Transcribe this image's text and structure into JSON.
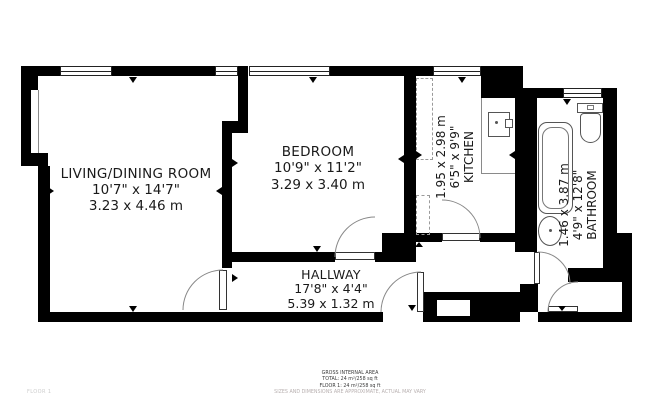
{
  "meta": {
    "floor_label": "FLOOR 1"
  },
  "rooms": [
    {
      "id": "living",
      "name": "LIVING/DINING ROOM",
      "imperial": "10'7\" x 14'7\"",
      "metric": "3.23 x 4.46 m"
    },
    {
      "id": "bedroom",
      "name": "BEDROOM",
      "imperial": "10'9\" x 11'2\"",
      "metric": "3.29 x 3.40 m"
    },
    {
      "id": "kitchen",
      "name": "KITCHEN",
      "imperial": "6'5\" x 9'9\"",
      "metric": "1.95 x 2.98 m"
    },
    {
      "id": "bathroom",
      "name": "BATHROOM",
      "imperial": "4'9\" x 12'8\"",
      "metric": "1.46 x 3.87 m"
    },
    {
      "id": "hallway",
      "name": "HALLWAY",
      "imperial": "17'8\" x 4'4\"",
      "metric": "5.39 x 1.32 m"
    }
  ],
  "footer": {
    "line1": "GROSS INTERNAL AREA",
    "line2": "TOTAL: 24 m²/258 sq ft",
    "line3": "FLOOR 1: 24 m²/258 sq ft",
    "disclaimer": "SIZES AND DIMENSIONS ARE APPROXIMATE, ACTUAL MAY VARY"
  },
  "fixtures": [
    "kitchen-sink",
    "bathtub",
    "toilet",
    "wash-basin"
  ],
  "colors": {
    "wall": "#000000",
    "door_arc": "#888888",
    "fixture_stroke": "#555555",
    "disclaimer_text": "#b8b0b0",
    "floor_label_text": "#cccccc"
  }
}
